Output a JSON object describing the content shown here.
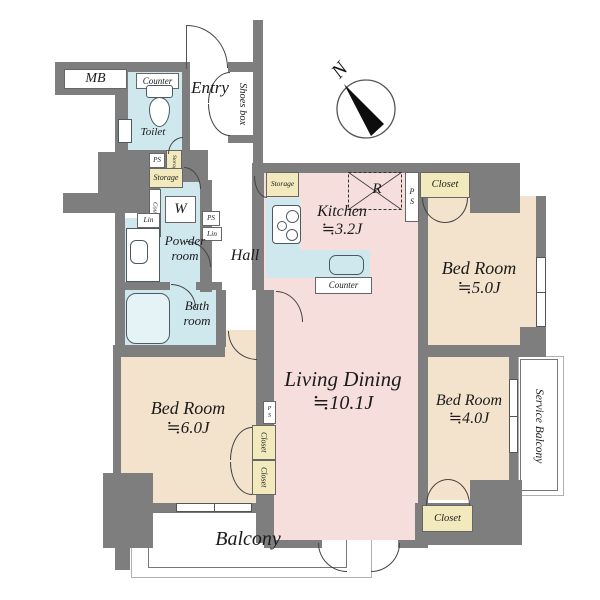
{
  "compass": {
    "north": "N"
  },
  "colors": {
    "wall": "#7e7e7e",
    "wet_area": "#cfe8ee",
    "ldk_pink": "#f5dedb",
    "bedroom_beige": "#f3e3cd",
    "closet_yellow": "#f2e9bd",
    "outline": "#555555",
    "background": "#ffffff"
  },
  "rooms": {
    "entry": {
      "name": "Entry"
    },
    "shoes_box": {
      "name": "Shoes box"
    },
    "mb": {
      "name": "MB"
    },
    "toilet": {
      "name": "Toilet",
      "counter": "Counter"
    },
    "powder_room": {
      "line1": "Powder",
      "line2": "room",
      "washer": "W"
    },
    "bath_room": {
      "line1": "Bath",
      "line2": "room"
    },
    "hall": {
      "name": "Hall"
    },
    "kitchen": {
      "name": "Kitchen",
      "size": "≒3.2J",
      "counter": "Counter",
      "refrigerator": "R",
      "storage": "Storage"
    },
    "living_dining": {
      "name": "Living Dining",
      "size": "≒10.1J"
    },
    "bed_room_north": {
      "name": "Bed Room",
      "size": "≒5.0J",
      "closet": "Closet"
    },
    "bed_room_east": {
      "name": "Bed Room",
      "size": "≒4.0J",
      "closet": "Closet"
    },
    "bed_room_west": {
      "name": "Bed Room",
      "size": "≒6.0J",
      "closet_upper": "Closet",
      "closet_lower": "Closet"
    },
    "balcony": {
      "name": "Balcony"
    },
    "service_balcony": {
      "name": "Service Balcony"
    }
  },
  "utility": {
    "ps_entry": "PS",
    "storage_entry": "Storage",
    "storage_hall": "Storage",
    "counter_hall": "Counter",
    "ps_powder": "PS",
    "lin_powder": "Lin",
    "lin_west": "Lin",
    "ps_kitchen": "PS",
    "ps_living": "PS"
  }
}
